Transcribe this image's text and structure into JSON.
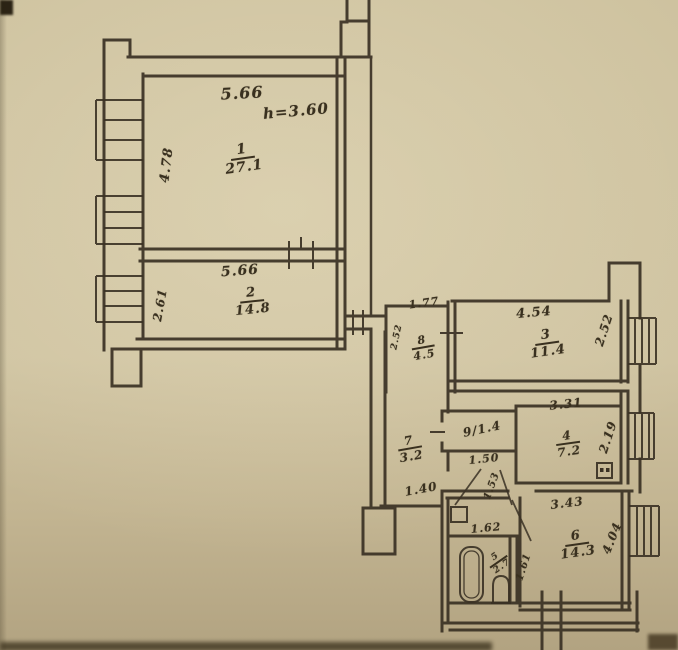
{
  "plan": {
    "type": "apartment floor plan (scanned hand-drawn BTI blueprint)",
    "colors": {
      "paper": "#cec29f",
      "ink": "#3a3124"
    },
    "rooms": {
      "r1": {
        "number": "1",
        "area": "27.1",
        "width": "5.66",
        "height": "4.78",
        "note": "h=3.60"
      },
      "r2": {
        "number": "2",
        "area": "14.8",
        "width": "5.66",
        "height": "2.61"
      },
      "r3": {
        "number": "3",
        "area": "11.4",
        "width": "4.54",
        "height": "2.52"
      },
      "r4": {
        "number": "4",
        "area": "7.2",
        "width": "3.31",
        "height": "2.19"
      },
      "r5": {
        "number": "5",
        "area": "2.7"
      },
      "r6": {
        "number": "6",
        "area": "14.3",
        "width": "3.43",
        "height": "4.04"
      },
      "r7": {
        "number": "7",
        "area": "3.2"
      },
      "r8": {
        "number": "8",
        "area": "4.5",
        "width": "1.77",
        "height": "2.52"
      },
      "r9": {
        "label": "9/1.4"
      }
    },
    "dimensions": {
      "passage_below_closet": "1.50",
      "passage_to_room6": "1.53",
      "corridor_width": "1.40",
      "bath_width": "1.62",
      "bath_depth": "1.61"
    }
  }
}
